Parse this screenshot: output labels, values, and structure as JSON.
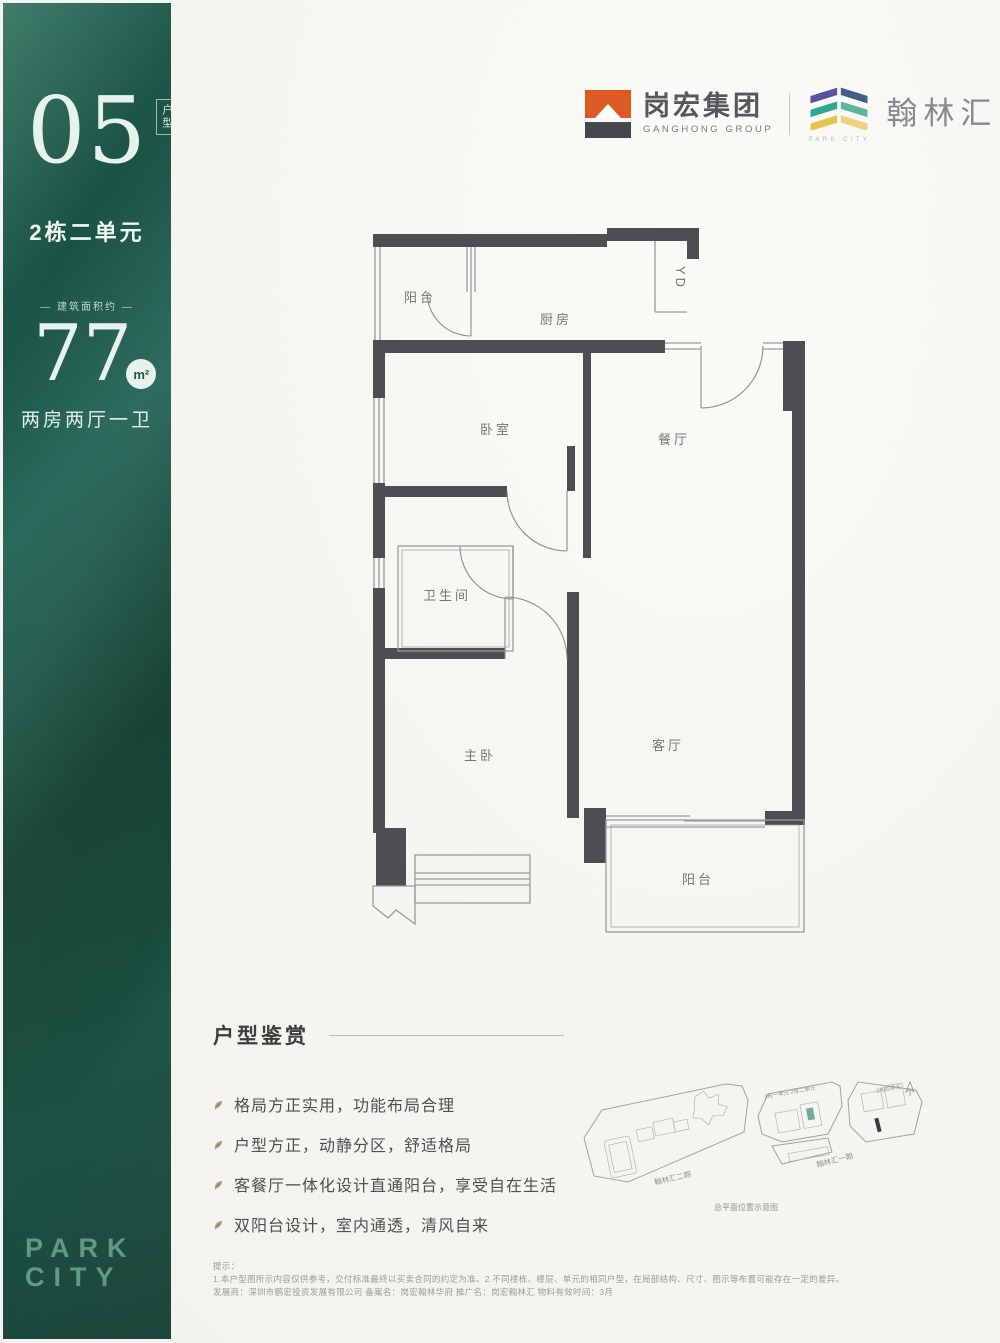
{
  "sidebar": {
    "unit_number": "05",
    "unit_tag": "户型",
    "building": "2栋二单元",
    "area_label": "— 建筑面积约 —",
    "area_value": "77",
    "area_unit": "m²",
    "room_config": "两房两厅一卫",
    "brand_line1": "PARK",
    "brand_line2": "CITY"
  },
  "header": {
    "ganghong_cn": "岗宏集团",
    "ganghong_en": "GANGHONG GROUP",
    "hanlin_cn": "翰林汇",
    "hanlin_en": "PARK CITY"
  },
  "floorplan": {
    "rooms": {
      "balcony_top": "阳台",
      "kitchen": "厨房",
      "yd": "YD",
      "bedroom": "卧室",
      "dining": "餐厅",
      "bathroom": "卫生间",
      "master_bedroom": "主卧",
      "living_room": "客厅",
      "balcony_bottom": "阳台"
    }
  },
  "features": {
    "title": "户型鉴赏",
    "items": [
      "格局方正实用，功能布局合理",
      "户型方正，动静分区，舒适格局",
      "客餐厅一体化设计直通阳台，享受自在生活",
      "双阳台设计，室内通透，清风自来"
    ]
  },
  "sitemap": {
    "phase2_label": "翰林汇二期",
    "phase1_label": "翰林汇一期",
    "unit_label_left": "2栋一单元 2栋二单元",
    "unit_label_right": "2栋四单元",
    "caption": "总平面位置示意图"
  },
  "disclaimer": {
    "intro": "提示：",
    "line1": "1.本户型图所示内容仅供参考，交付标准最终以买卖合同的约定为准。2.不同楼栋、楼层、单元的相同户型，在局部结构、尺寸、图示等布置可能存在一定的差异。",
    "line2": "发展商：深圳市鹏宏投资发展有限公司 备案名：岗宏翰林华府 推广名：岗宏翰林汇 物料有效时间：3月"
  },
  "colors": {
    "sidebar_green": "#1d5848",
    "accent_orange": "#dd5a25",
    "wall_dark": "#4d4d52",
    "highlight_green": "#6fae97"
  }
}
